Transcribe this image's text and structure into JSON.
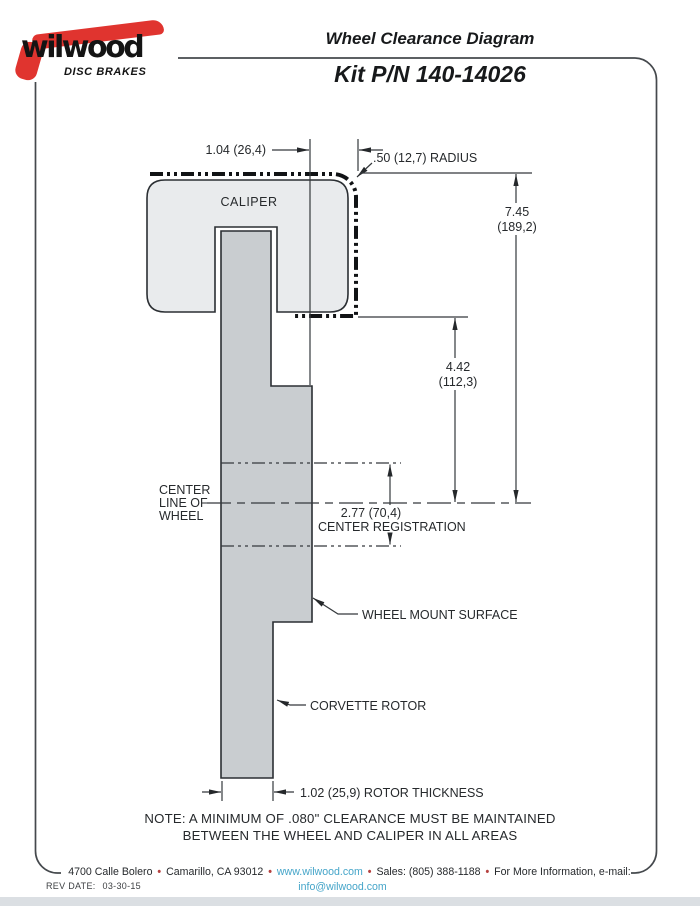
{
  "header": {
    "brand": "wilwood",
    "brand_tagline": "DISC BRAKES",
    "title": "Wheel Clearance Diagram",
    "kit_number": "Kit P/N 140-14026"
  },
  "diagram": {
    "caliper_label": "CALIPER",
    "dimensions": {
      "caliper_overhang": "1.04 (26,4)",
      "corner_radius": ".50 (12,7) RADIUS",
      "overall_height_in": "7.45",
      "overall_height_mm": "(189,2)",
      "caliper_to_centerline_in": "4.42",
      "caliper_to_centerline_mm": "(112,3)",
      "center_registration_value": "2.77 (70,4)",
      "center_registration_label": "CENTER REGISTRATION",
      "rotor_thickness": "1.02 (25,9) ROTOR THICKNESS"
    },
    "labels": {
      "center_line_1": "CENTER",
      "center_line_2": "LINE OF",
      "center_line_3": "WHEEL",
      "wheel_mount_surface": "WHEEL MOUNT SURFACE",
      "corvette_rotor": "CORVETTE ROTOR"
    },
    "colors": {
      "caliper_fill": "#e9ebed",
      "rotor_fill": "#c9cdd0",
      "line": "#25282b",
      "logo_red": "#e0342f"
    }
  },
  "note": {
    "line1": "NOTE: A MINIMUM OF .080\" CLEARANCE MUST BE MAINTAINED",
    "line2": "BETWEEN THE WHEEL AND CALIPER IN ALL AREAS"
  },
  "footer": {
    "address": "4700 Calle Bolero",
    "separator": "•",
    "city": "Camarillo, CA 93012",
    "website": "www.wilwood.com",
    "sales": "Sales: (805) 388-1188",
    "more_info": "For More Information, e-mail:",
    "email": "info@wilwood.com",
    "rev_label": "REV DATE:",
    "rev_date": "03-30-15",
    "link_color": "#45a5c9",
    "separator_color": "#b5413f"
  }
}
